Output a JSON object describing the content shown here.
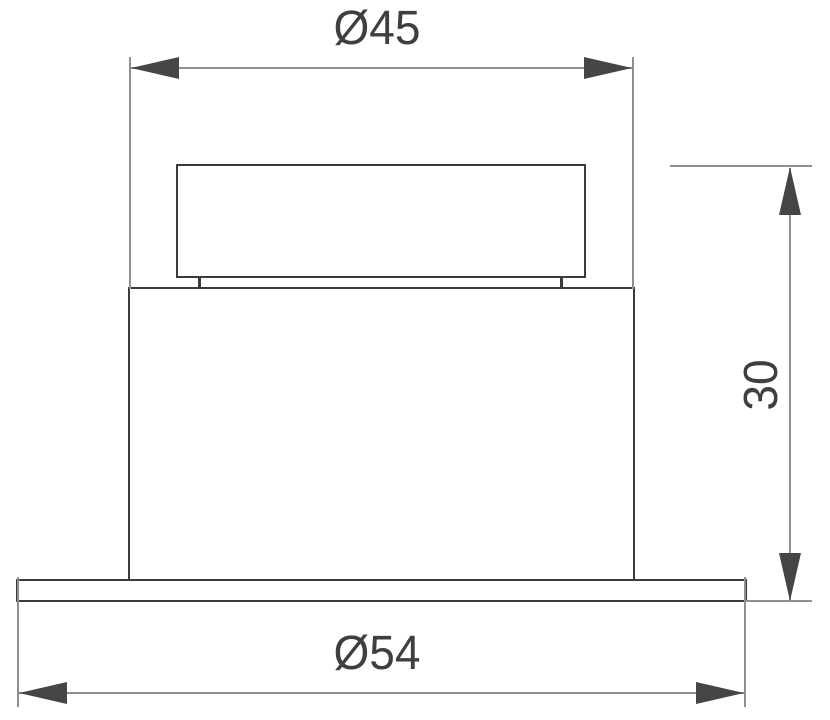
{
  "drawing": {
    "kind": "technical-dimension-drawing",
    "view": "front-section-of-recessed-downlight",
    "dimensions": {
      "top": {
        "label": "Ø45",
        "value": "45",
        "symbol": "diameter",
        "orientation": "horizontal"
      },
      "right": {
        "label": "30",
        "value": "30",
        "orientation": "vertical"
      },
      "bottom": {
        "label": "Ø54",
        "value": "54",
        "symbol": "diameter",
        "orientation": "horizontal"
      }
    },
    "colors": {
      "outline": "#3b3b3b",
      "dimension_line": "#8f8f8f",
      "arrow": "#454545",
      "text": "#3f3f3f",
      "background": "#ffffff"
    }
  }
}
